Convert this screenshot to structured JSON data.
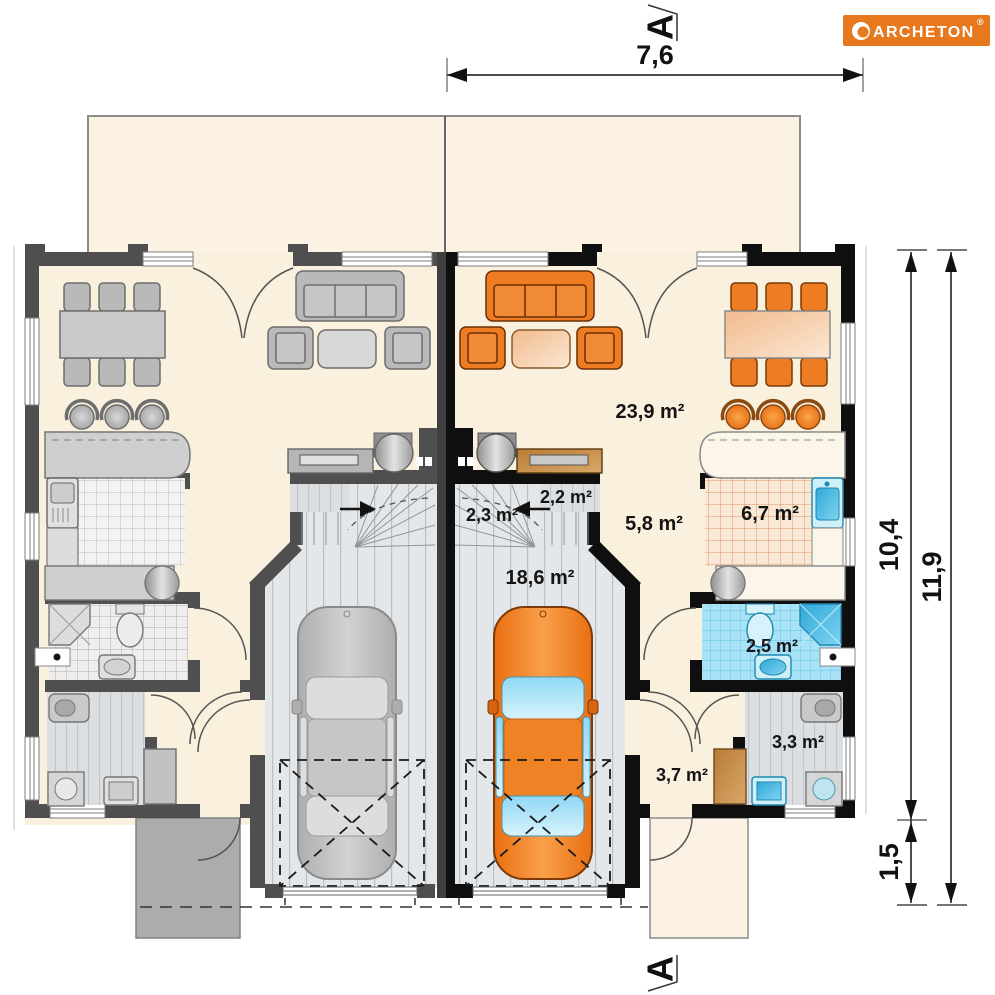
{
  "brand": {
    "logo_text": "ARCHETON",
    "registered_mark": "®"
  },
  "section_markers": {
    "top": "A",
    "bottom": "A"
  },
  "dimensions": {
    "top_width": "7,6",
    "right_inner": "10,4",
    "right_outer": "11,9",
    "right_lower": "1,5"
  },
  "rooms": {
    "living_room": "23,9 m²",
    "closet": "2,2 m²",
    "staircase": "2,3 m²",
    "hall": "5,8 m²",
    "garage": "18,6 m²",
    "kitchen": "6,7 m²",
    "bathroom": "2,5 m²",
    "utility_room": "3,3 m²",
    "vestibule": "3,7 m²"
  },
  "colors": {
    "logo_background": "#E8781E",
    "furniture_orange": "#EE7C22",
    "fixture_blue": "#45BCE5",
    "floor_cream": "#FAF0DE",
    "terrace_cream": "#FBF2E3",
    "wall_dark": "#0F0F0F",
    "wall_gray": "#4F4F4F"
  }
}
